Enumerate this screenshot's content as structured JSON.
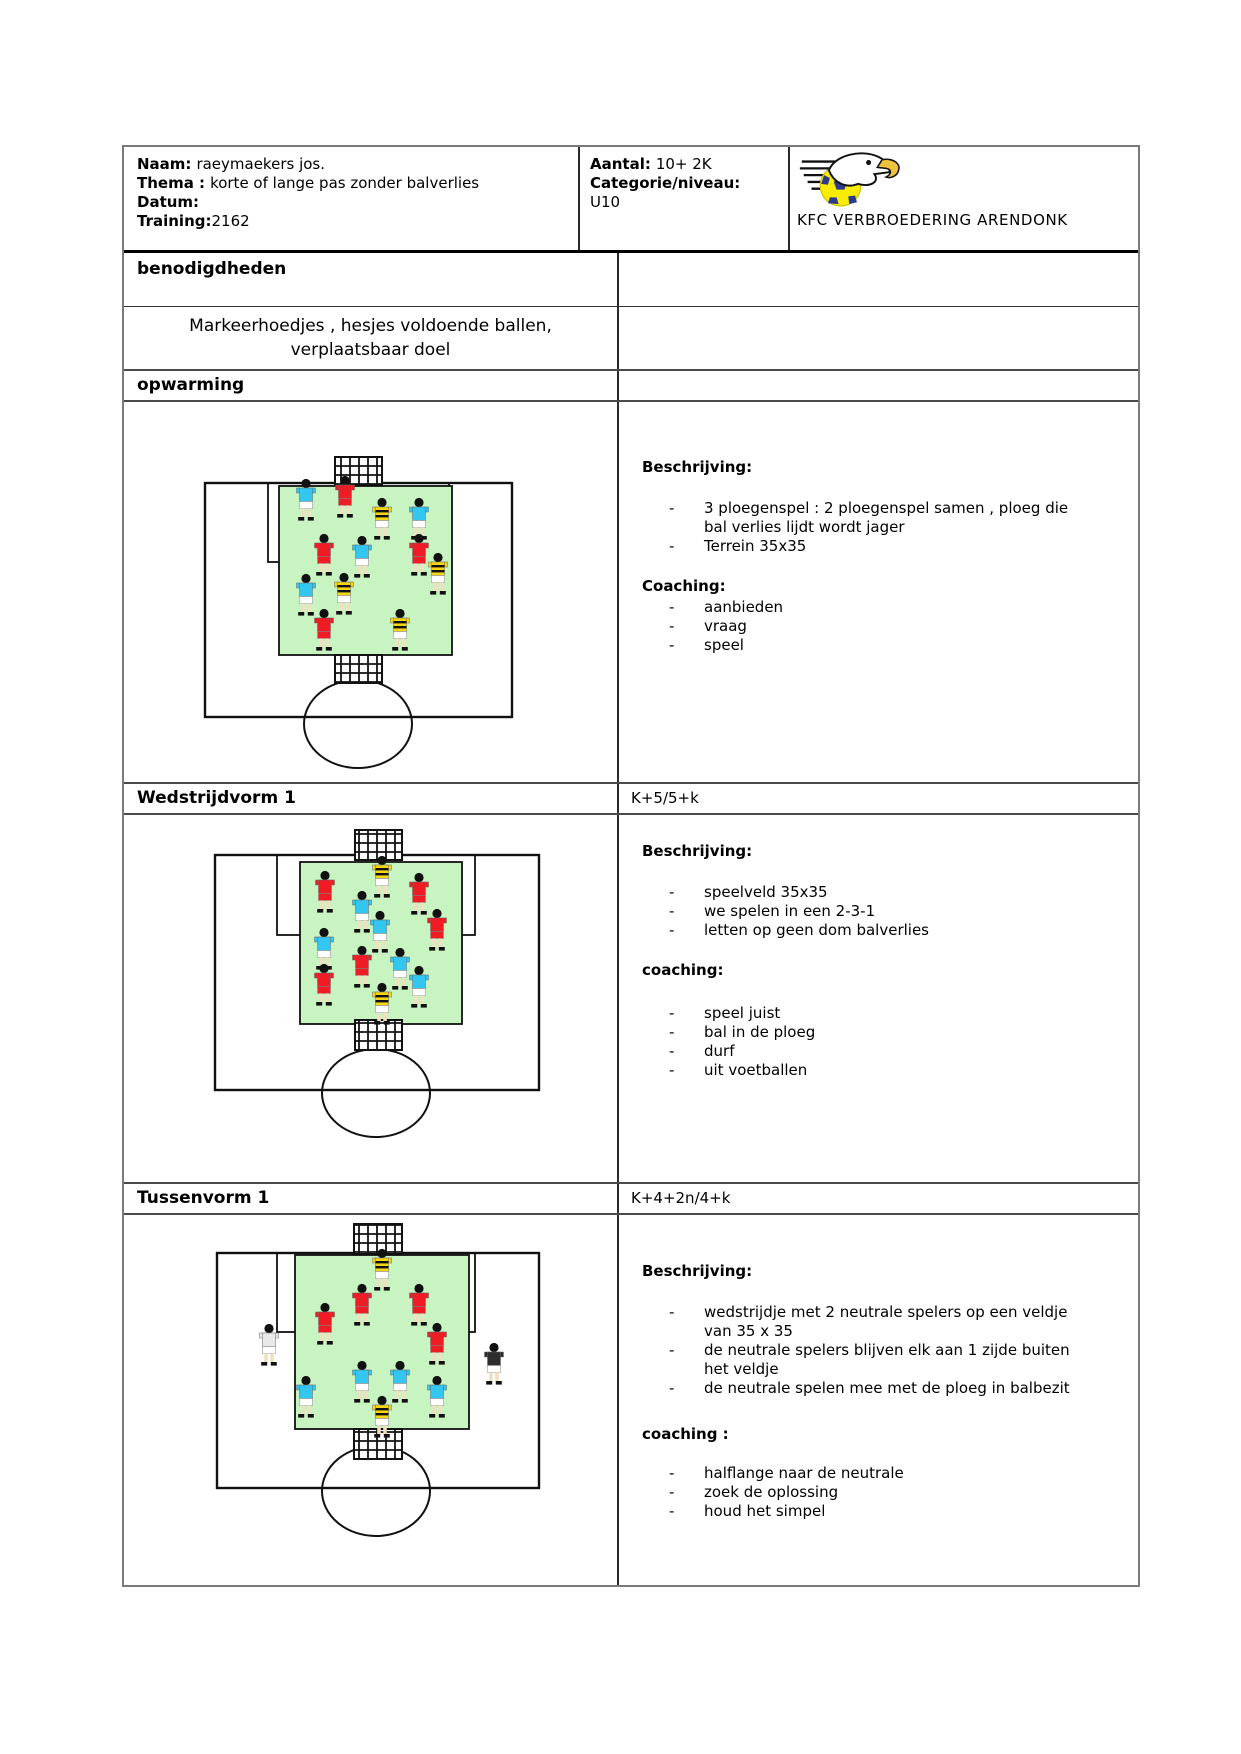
{
  "header": {
    "naam_label": "Naam:",
    "naam_value": "raeymaekers jos.",
    "thema_label": "Thema :",
    "thema_value": "korte of lange pas zonder balverlies",
    "datum_label": "Datum:",
    "datum_value": "",
    "training_label": "Training:",
    "training_value": "2162",
    "aantal_label": "Aantal:",
    "aantal_value": "10+ 2K",
    "categorie_label": "Categorie/niveau:",
    "categorie_value": "U10",
    "club_name": "KFC VERBROEDERING ARENDONK"
  },
  "benodigdheden": {
    "title": "benodigdheden",
    "lines": [
      "Markeerhoedjes , hesjes voldoende ballen,",
      "verplaatsbaar doel"
    ]
  },
  "sections": [
    {
      "title": "opwarming",
      "subtitle": "",
      "beschrijving_heading": "Beschrijving:",
      "beschrijving_bullets": [
        [
          "3 ploegenspel : 2 ploegenspel samen , ploeg die",
          "bal verlies lijdt wordt jager"
        ],
        [
          "Terrein 35x35"
        ]
      ],
      "coaching_heading": "Coaching:",
      "coaching_bullets": [
        [
          "aanbieden"
        ],
        [
          "vraag"
        ],
        [
          "speel"
        ]
      ]
    },
    {
      "title": "Wedstrijdvorm 1",
      "subtitle": "K+5/5+k",
      "beschrijving_heading": "Beschrijving:",
      "beschrijving_bullets": [
        [
          "speelveld 35x35"
        ],
        [
          "we spelen in een 2-3-1"
        ],
        [
          "letten op geen dom balverlies"
        ]
      ],
      "coaching_heading": "coaching:",
      "coaching_bullets": [
        [
          "speel juist"
        ],
        [
          "bal in de ploeg"
        ],
        [
          "durf"
        ],
        [
          "uit voetballen"
        ]
      ]
    },
    {
      "title": "Tussenvorm 1",
      "subtitle": "K+4+2n/4+k",
      "beschrijving_heading": "Beschrijving:",
      "beschrijving_bullets": [
        [
          "wedstrijdje met 2 neutrale spelers op een veldje",
          "van 35 x 35"
        ],
        [
          "de neutrale spelers blijven elk aan 1 zijde buiten",
          "het veldje"
        ],
        [
          "de neutrale spelen mee met de ploeg in balbezit"
        ]
      ],
      "coaching_heading": "coaching :",
      "coaching_bullets": [
        [
          "halflange naar de neutrale"
        ],
        [
          "zoek de oplossing"
        ],
        [
          "houd het simpel"
        ]
      ]
    }
  ],
  "colors": {
    "pitch_green": "#c8f4c2",
    "line_black": "#111111",
    "logo_ball_yellow": "#f8ec00",
    "logo_patch_blue": "#2d3a8c",
    "logo_beak_yellow": "#eec13e"
  },
  "teams": {
    "red": {
      "shirt": "#ee1c25",
      "shorts": "#ee1c25",
      "striped": false
    },
    "cyan": {
      "shirt": "#33c6f1",
      "shorts": "#ffffff",
      "striped": false
    },
    "striped": {
      "shirt": "#f6d515",
      "shorts": "#ffffff",
      "striped": true
    },
    "keeper": {
      "shirt": "#f6d515",
      "shorts": "#ffffff",
      "striped": true
    },
    "neutral_light": {
      "shirt": "#e9e9e9",
      "shorts": "#ffffff",
      "striped": false
    },
    "neutral_dark": {
      "shirt": "#2d2d2d",
      "shorts": "#ffffff",
      "striped": false
    }
  },
  "diagrams": [
    {
      "name": "opwarming-field",
      "w": 495,
      "h": 382,
      "goal_top": {
        "x": 211,
        "y": 55,
        "w": 47,
        "h": 28
      },
      "field": {
        "x": 81,
        "y": 81,
        "w": 307,
        "h": 234
      },
      "goal_area": {
        "x": 144,
        "y": 81,
        "w": 181,
        "h": 79
      },
      "pitch": {
        "x": 155,
        "y": 84,
        "w": 173,
        "h": 169
      },
      "goal_bottom": {
        "x": 211,
        "y": 253,
        "w": 47,
        "h": 28
      },
      "circle": {
        "cx": 234,
        "cy": 322,
        "rx": 54,
        "ry": 44
      },
      "players": [
        {
          "x": 182,
          "y": 98,
          "team": "cyan"
        },
        {
          "x": 221,
          "y": 95,
          "team": "red"
        },
        {
          "x": 258,
          "y": 117,
          "team": "striped"
        },
        {
          "x": 295,
          "y": 117,
          "team": "cyan"
        },
        {
          "x": 200,
          "y": 153,
          "team": "red"
        },
        {
          "x": 238,
          "y": 155,
          "team": "cyan"
        },
        {
          "x": 295,
          "y": 153,
          "team": "red"
        },
        {
          "x": 314,
          "y": 172,
          "team": "striped"
        },
        {
          "x": 182,
          "y": 193,
          "team": "cyan"
        },
        {
          "x": 220,
          "y": 192,
          "team": "striped"
        },
        {
          "x": 200,
          "y": 228,
          "team": "red"
        },
        {
          "x": 276,
          "y": 228,
          "team": "striped"
        }
      ]
    },
    {
      "name": "wedstrijdvorm-field",
      "w": 495,
      "h": 369,
      "goal_top": {
        "x": 231,
        "y": 15,
        "w": 47,
        "h": 30
      },
      "field": {
        "x": 91,
        "y": 40,
        "w": 324,
        "h": 235
      },
      "goal_area": {
        "x": 153,
        "y": 40,
        "w": 198,
        "h": 80
      },
      "pitch": {
        "x": 176,
        "y": 47,
        "w": 162,
        "h": 162
      },
      "goal_bottom": {
        "x": 231,
        "y": 205,
        "w": 47,
        "h": 30
      },
      "circle": {
        "cx": 252,
        "cy": 278,
        "rx": 54,
        "ry": 44
      },
      "players": [
        {
          "x": 258,
          "y": 62,
          "team": "keeper"
        },
        {
          "x": 201,
          "y": 77,
          "team": "red"
        },
        {
          "x": 295,
          "y": 79,
          "team": "red"
        },
        {
          "x": 238,
          "y": 97,
          "team": "cyan"
        },
        {
          "x": 256,
          "y": 117,
          "team": "cyan"
        },
        {
          "x": 313,
          "y": 115,
          "team": "red"
        },
        {
          "x": 200,
          "y": 134,
          "team": "cyan"
        },
        {
          "x": 238,
          "y": 152,
          "team": "red"
        },
        {
          "x": 276,
          "y": 154,
          "team": "cyan"
        },
        {
          "x": 200,
          "y": 170,
          "team": "red"
        },
        {
          "x": 295,
          "y": 172,
          "team": "cyan"
        },
        {
          "x": 258,
          "y": 189,
          "team": "keeper"
        }
      ]
    },
    {
      "name": "tussenvorm-field",
      "w": 495,
      "h": 370,
      "goal_top": {
        "x": 230,
        "y": 9,
        "w": 48,
        "h": 30
      },
      "field": {
        "x": 93,
        "y": 38,
        "w": 322,
        "h": 235
      },
      "goal_area": {
        "x": 153,
        "y": 38,
        "w": 198,
        "h": 79
      },
      "pitch": {
        "x": 171,
        "y": 40,
        "w": 174,
        "h": 174
      },
      "goal_bottom": {
        "x": 230,
        "y": 214,
        "w": 48,
        "h": 30
      },
      "circle": {
        "cx": 252,
        "cy": 276,
        "rx": 54,
        "ry": 45
      },
      "players": [
        {
          "x": 258,
          "y": 55,
          "team": "keeper"
        },
        {
          "x": 238,
          "y": 90,
          "team": "red"
        },
        {
          "x": 295,
          "y": 90,
          "team": "red"
        },
        {
          "x": 201,
          "y": 109,
          "team": "red"
        },
        {
          "x": 313,
          "y": 129,
          "team": "red"
        },
        {
          "x": 145,
          "y": 130,
          "team": "neutral_light"
        },
        {
          "x": 370,
          "y": 149,
          "team": "neutral_dark"
        },
        {
          "x": 238,
          "y": 167,
          "team": "cyan"
        },
        {
          "x": 276,
          "y": 167,
          "team": "cyan"
        },
        {
          "x": 182,
          "y": 182,
          "team": "cyan"
        },
        {
          "x": 313,
          "y": 182,
          "team": "cyan"
        },
        {
          "x": 258,
          "y": 202,
          "team": "keeper"
        }
      ]
    }
  ]
}
